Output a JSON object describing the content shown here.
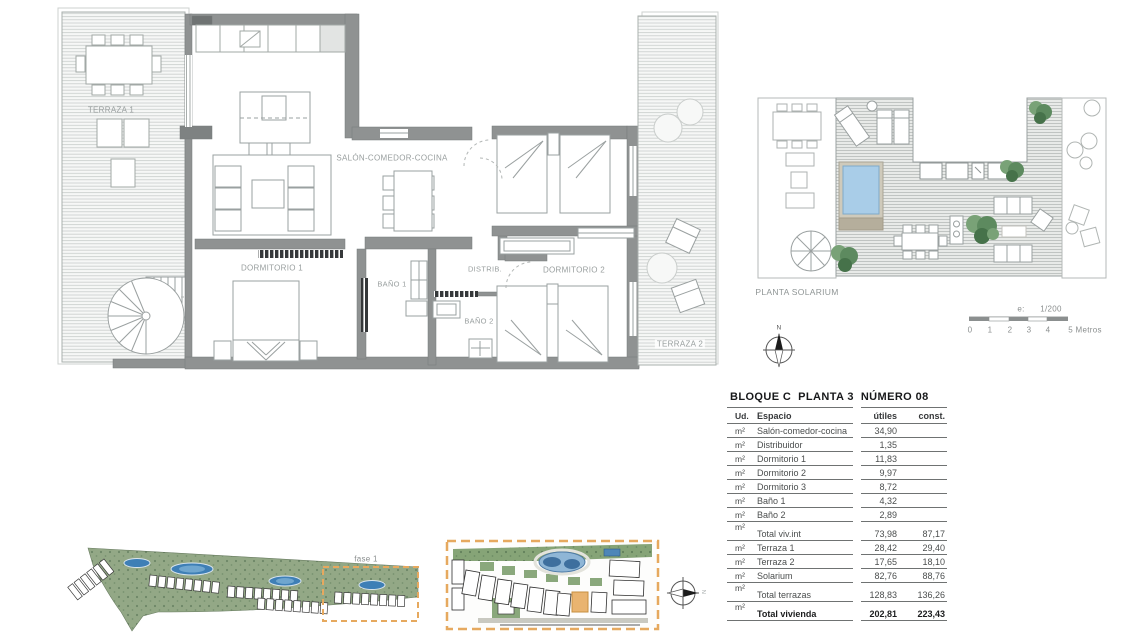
{
  "floor_plan": {
    "rooms": {
      "terraza1": "TERRAZA 1",
      "salon": "SALÓN-COMEDOR-COCINA",
      "dormitorio1": "DORMITORIO 1",
      "bano1": "BAÑO 1",
      "bano2": "BAÑO 2",
      "distrib": "DISTRIB.",
      "dormitorio2": "DORMITORIO 2",
      "terraza2": "TERRAZA 2"
    }
  },
  "solarium_plan": {
    "title": "PLANTA SOLARIUM",
    "scale_prefix": "e:",
    "scale_ratio": "1/200",
    "scale_ticks": [
      "0",
      "1",
      "2",
      "3",
      "4"
    ],
    "scale_unit": "5 Metros"
  },
  "compasses": {
    "main_north": "N",
    "site_north": "N"
  },
  "site_overview": {
    "phase_label": "fase 1"
  },
  "area_table": {
    "title": "BLOQUE C  PLANTA 3  NÚMERO 08",
    "columns": {
      "ud": "Ud.",
      "espacio": "Espacio",
      "utiles": "útiles",
      "const": "const."
    },
    "rows": [
      {
        "ud": "m²",
        "espacio": "Salón-comedor-cocina",
        "utiles": "34,90",
        "const": ""
      },
      {
        "ud": "m²",
        "espacio": "Distribuidor",
        "utiles": "1,35",
        "const": ""
      },
      {
        "ud": "m²",
        "espacio": "Dormitorio 1",
        "utiles": "11,83",
        "const": ""
      },
      {
        "ud": "m²",
        "espacio": "Dormitorio 2",
        "utiles": "9,97",
        "const": ""
      },
      {
        "ud": "m²",
        "espacio": "Dormitorio 3",
        "utiles": "8,72",
        "const": ""
      },
      {
        "ud": "m²",
        "espacio": "Baño 1",
        "utiles": "4,32",
        "const": ""
      },
      {
        "ud": "m²",
        "espacio": "Baño 2",
        "utiles": "2,89",
        "const": ""
      },
      {
        "ud": "m²",
        "espacio": "Total viv.int",
        "utiles": "73,98",
        "const": "87,17",
        "group": true
      },
      {
        "ud": "m²",
        "espacio": "Terraza 1",
        "utiles": "28,42",
        "const": "29,40"
      },
      {
        "ud": "m²",
        "espacio": "Terraza 2",
        "utiles": "17,65",
        "const": "18,10"
      },
      {
        "ud": "m²",
        "espacio": "Solarium",
        "utiles": "82,76",
        "const": "88,76"
      },
      {
        "ud": "m²",
        "espacio": "Total terrazas",
        "utiles": "128,83",
        "const": "136,26",
        "group": true
      },
      {
        "ud": "m²",
        "espacio": "Total vivienda",
        "utiles": "202,81",
        "const": "223,43",
        "group": true,
        "bold": true
      }
    ]
  },
  "colors": {
    "accent_orange": "#e6a95f",
    "pool_blue": "#a9cde8",
    "wall_gray": "#8f9292",
    "site_green": "#93a886",
    "label_gray": "#989e9e"
  }
}
